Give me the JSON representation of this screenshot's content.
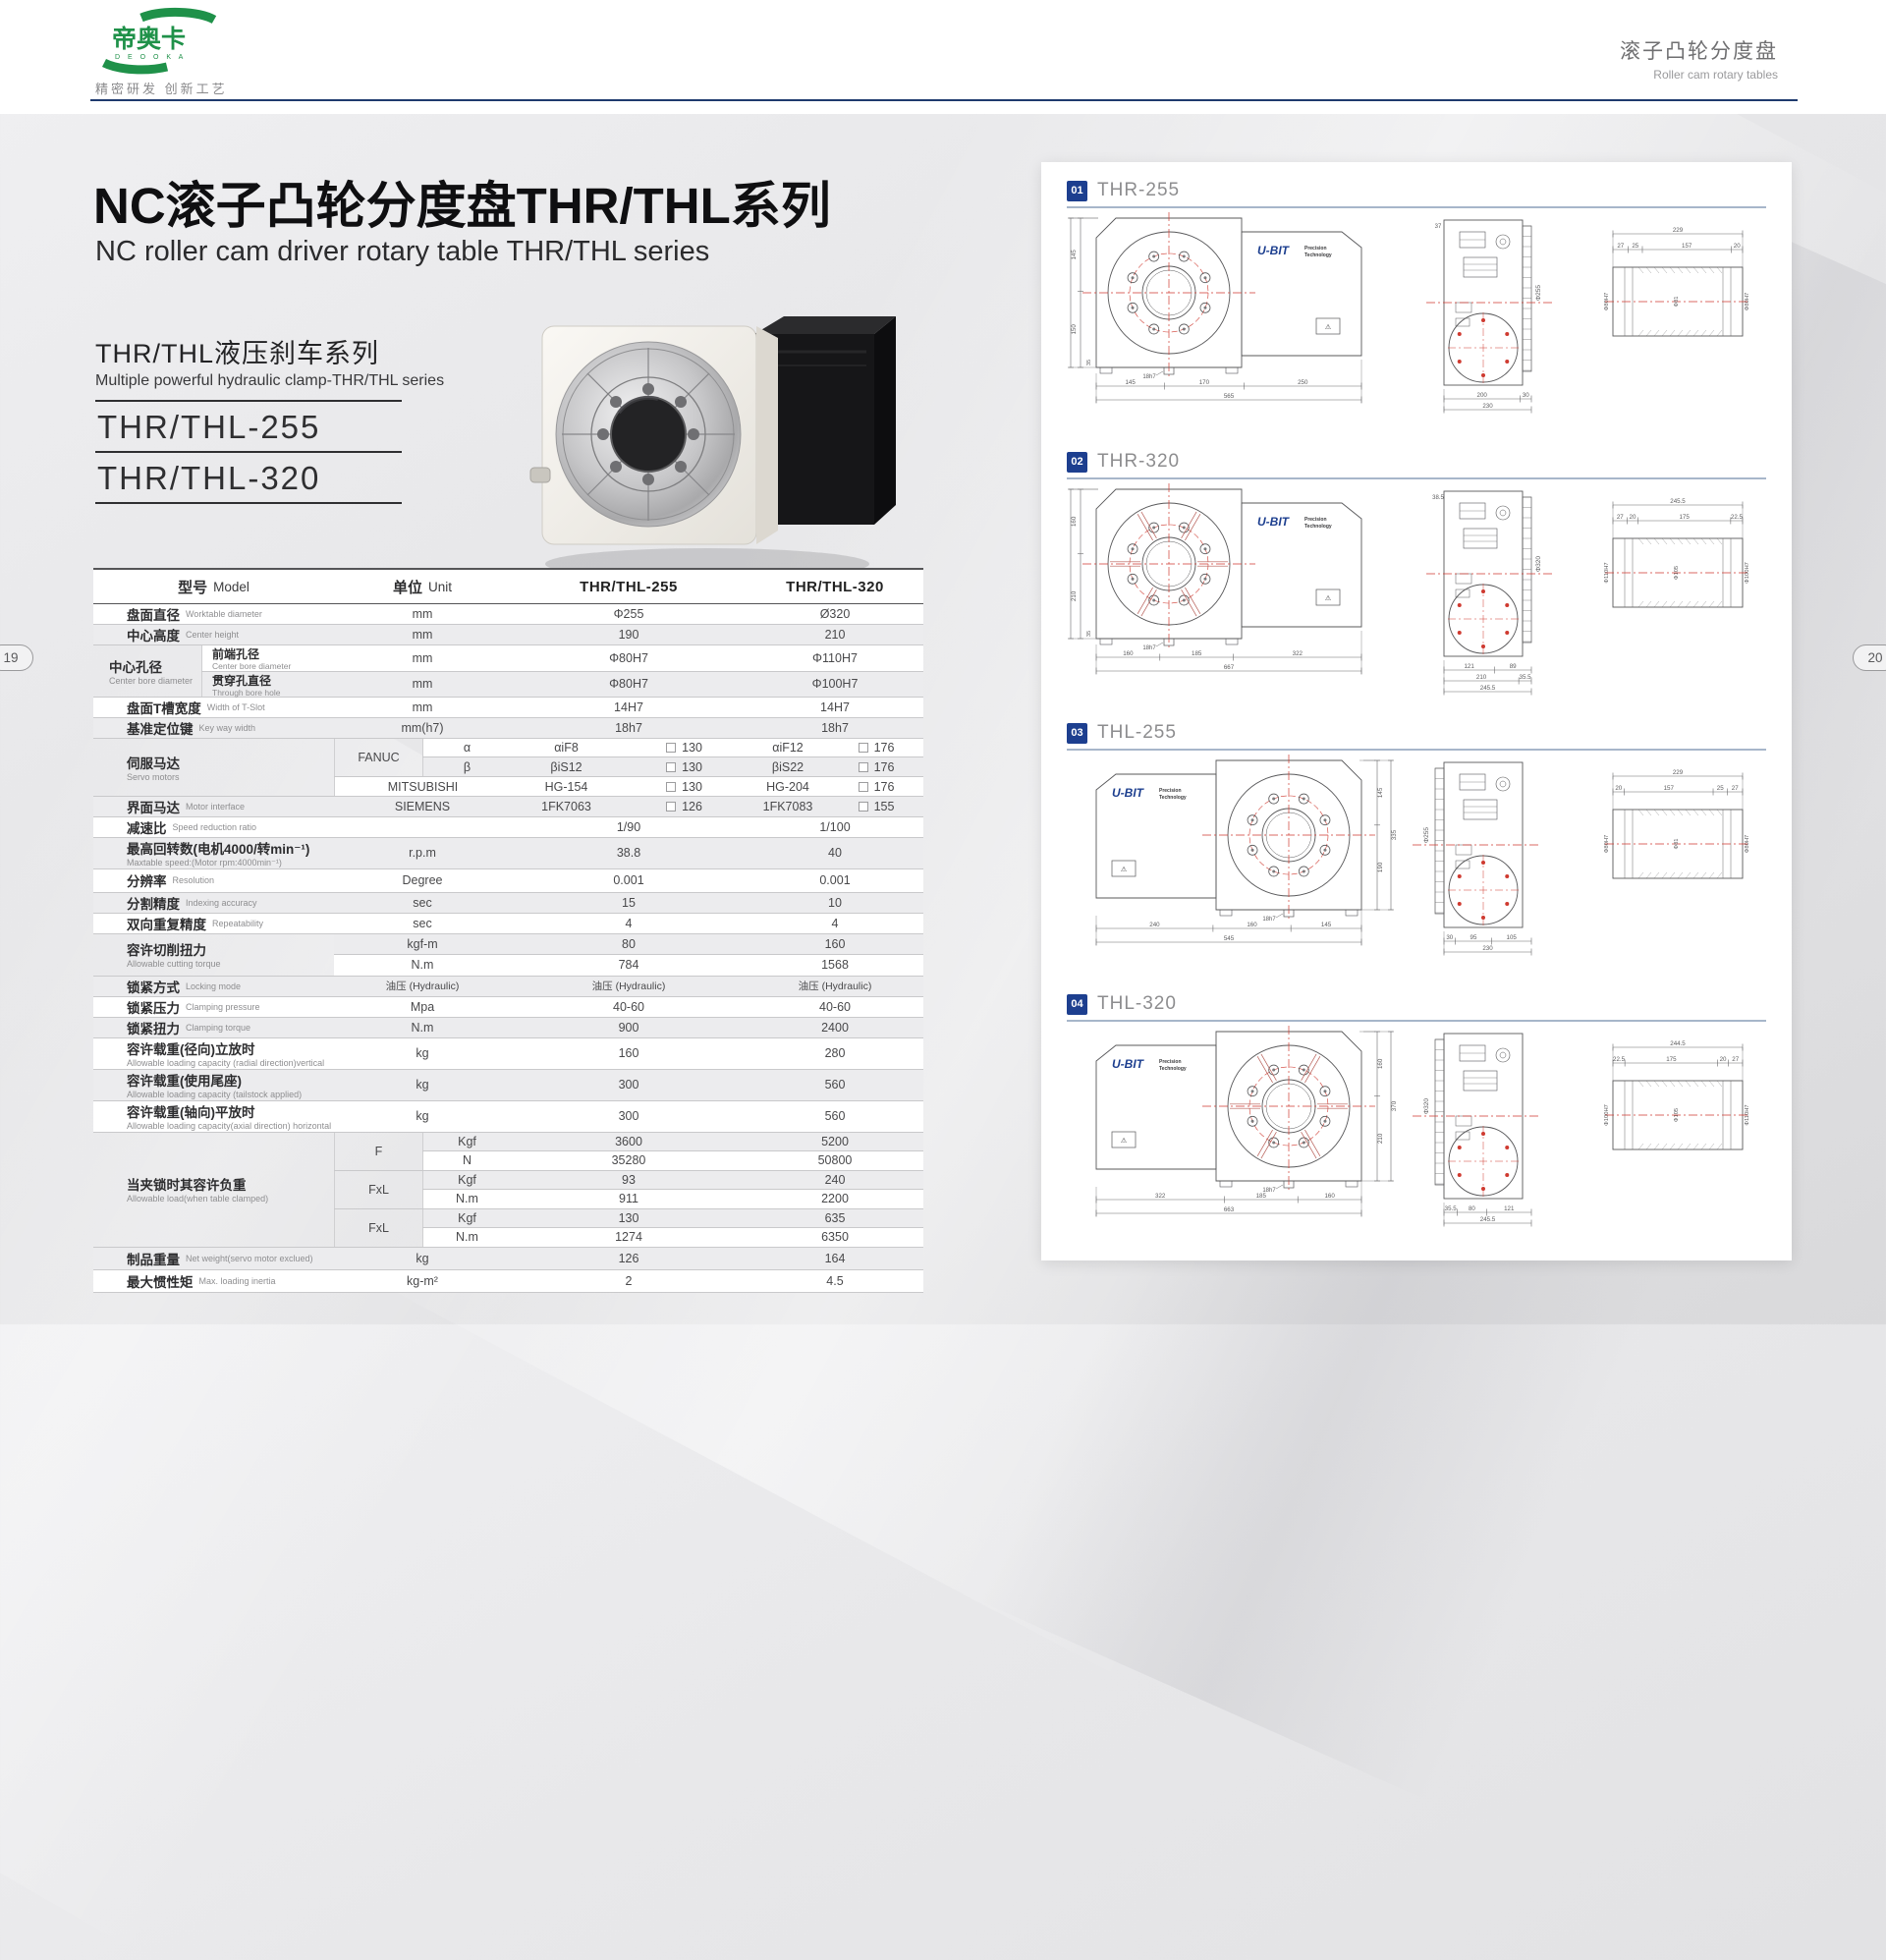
{
  "page": {
    "left_badge": "19",
    "right_badge": "20"
  },
  "header": {
    "logo_zh": "帝奥卡",
    "logo_latin": "D E O O K A",
    "tagline": "精密研发 创新工艺",
    "right_zh": "滚子凸轮分度盘",
    "right_en": "Roller cam rotary tables"
  },
  "intro": {
    "title_zh": "NC滚子凸轮分度盘THR/THL系列",
    "title_en": "NC roller cam driver rotary table THR/THL series",
    "series_zh": "THR/THL液压刹车系列",
    "series_en": "Multiple powerful hydraulic clamp-THR/THL series",
    "models": [
      "THR/THL-255",
      "THR/THL-320"
    ]
  },
  "spec_table": {
    "headers": {
      "model_zh": "型号",
      "model_en": "Model",
      "unit_zh": "单位",
      "unit_en": "Unit",
      "col_a": "THR/THL-255",
      "col_b": "THR/THL-320"
    },
    "rows": [
      {
        "type": "simple",
        "zh": "盘面直径",
        "en": "Worktable diameter",
        "unit": "mm",
        "a": "Φ255",
        "b": "Ø320"
      },
      {
        "type": "simple",
        "zh": "中心高度",
        "en": "Center height",
        "unit": "mm",
        "a": "190",
        "b": "210"
      },
      {
        "type": "bore",
        "zh": "中心孔径",
        "en": "Center bore diameter",
        "subs": [
          {
            "zh": "前端孔径",
            "en": "Center bore diameter",
            "unit": "mm",
            "a": "Φ80H7",
            "b": "Φ110H7"
          },
          {
            "zh": "贯穿孔直径",
            "en": "Through bore hole",
            "unit": "mm",
            "a": "Φ80H7",
            "b": "Φ100H7"
          }
        ]
      },
      {
        "type": "simple",
        "zh": "盘面T槽宽度",
        "en": "Width of T-Slot",
        "unit": "mm",
        "a": "14H7",
        "b": "14H7"
      },
      {
        "type": "simple",
        "zh": "基准定位键",
        "en": "Key way width",
        "unit": "mm(h7)",
        "a": "18h7",
        "b": "18h7"
      },
      {
        "type": "servo",
        "zh": "伺服马达",
        "en": "Servo motors",
        "fanuc": {
          "brand": "FANUC",
          "rows": [
            {
              "sub": "α",
              "a": "αiF8",
              "af": "130",
              "b": "αiF12",
              "bf": "176"
            },
            {
              "sub": "β",
              "a": "βiS12",
              "af": "130",
              "b": "βiS22",
              "bf": "176"
            }
          ]
        },
        "mits": {
          "brand": "MITSUBISHI",
          "a": "HG-154",
          "af": "130",
          "b": "HG-204",
          "bf": "176"
        }
      },
      {
        "type": "servo1",
        "zh": "界面马达",
        "en": "Motor interface",
        "brand": "SIEMENS",
        "a": "1FK7063",
        "af": "126",
        "b": "1FK7083",
        "bf": "155"
      },
      {
        "type": "simple",
        "zh": "减速比",
        "en": "Speed reduction ratio",
        "unit": "",
        "a": "1/90",
        "b": "1/100"
      },
      {
        "type": "simple",
        "zh": "最高回转数(电机4000/转min⁻¹)",
        "en": "Maxtable speed:(Motor rpm:4000min⁻¹)",
        "unit": "r.p.m",
        "a": "38.8",
        "b": "40",
        "h": 28,
        "stack": true
      },
      {
        "type": "simple",
        "zh": "分辨率",
        "en": "Resolution",
        "unit": "Degree",
        "a": "0.001",
        "b": "0.001",
        "h": 24
      },
      {
        "type": "simple",
        "zh": "分割精度",
        "en": "Indexing accuracy",
        "unit": "sec",
        "a": "15",
        "b": "10"
      },
      {
        "type": "simple",
        "zh": "双向重复精度",
        "en": "Repeatability",
        "unit": "sec",
        "a": "4",
        "b": "4"
      },
      {
        "type": "dual",
        "zh": "容许切削扭力",
        "en": "Allowable cutting torque",
        "subs": [
          {
            "unit": "kgf-m",
            "a": "80",
            "b": "160"
          },
          {
            "unit": "N.m",
            "a": "784",
            "b": "1568"
          }
        ]
      },
      {
        "type": "simple",
        "zh": "锁紧方式",
        "en": "Locking mode",
        "unit": "油压 (Hydraulic)",
        "a": "油压 (Hydraulic)",
        "b": "油压 (Hydraulic)",
        "smallv": true
      },
      {
        "type": "simple",
        "zh": "锁紧压力",
        "en": "Clamping pressure",
        "unit": "Mpa",
        "a": "40-60",
        "b": "40-60"
      },
      {
        "type": "simple",
        "zh": "锁紧扭力",
        "en": "Clamping torque",
        "unit": "N.m",
        "a": "900",
        "b": "2400"
      },
      {
        "type": "simple",
        "zh": "容许载重(径向)立放时",
        "en": "Allowable loading capacity (radial direction)vertical",
        "unit": "kg",
        "a": "160",
        "b": "280",
        "h": 28,
        "stack": true
      },
      {
        "type": "simple",
        "zh": "容许载重(使用尾座)",
        "en": "Allowable loading capacity (tailstock applied)",
        "unit": "kg",
        "a": "300",
        "b": "560",
        "h": 28,
        "stack": true
      },
      {
        "type": "simple",
        "zh": "容许载重(轴向)平放时",
        "en": "Allowable loading capacity(axial direction) horizontal",
        "unit": "kg",
        "a": "300",
        "b": "560",
        "h": 32,
        "stack": true
      },
      {
        "type": "clamp",
        "zh": "当夹锁时其容许负重",
        "en": "Allowable load(when table clamped)",
        "pairs": [
          {
            "f": "F",
            "rows": [
              [
                "Kgf",
                "3600",
                "5200"
              ],
              [
                "N",
                "35280",
                "50800"
              ]
            ]
          },
          {
            "f": "FxL",
            "rows": [
              [
                "Kgf",
                "93",
                "240"
              ],
              [
                "N.m",
                "911",
                "2200"
              ]
            ]
          },
          {
            "f": "FxL",
            "rows": [
              [
                "Kgf",
                "130",
                "635"
              ],
              [
                "N.m",
                "1274",
                "6350"
              ]
            ]
          }
        ]
      },
      {
        "type": "simple",
        "zh": "制品重量",
        "en": "Net weight(servo motor exclued)",
        "unit": "kg",
        "a": "126",
        "b": "164",
        "h": 23
      },
      {
        "type": "simple",
        "zh": "最大惯性矩",
        "en": "Max. loading inertia",
        "unit": "kg-m²",
        "a": "2",
        "b": "4.5",
        "h": 23
      }
    ]
  },
  "drawings": {
    "brand": "U-BIT",
    "brand_sub1": "Precision",
    "brand_sub2": "Technology",
    "sections": [
      {
        "badge": "01",
        "title": "THR-255",
        "mirror": false,
        "spokes": false,
        "front": {
          "vdims": [
            "145",
            "335",
            "150"
          ],
          "bottom": [
            [
              "145",
              "170",
              "250"
            ],
            [
              "565"
            ]
          ],
          "key": "18h7",
          "foot": "35"
        },
        "side": {
          "top": "37",
          "dia": "Φ255",
          "bottom": [
            [
              "200",
              "30"
            ],
            [
              "230"
            ]
          ]
        },
        "end": {
          "top": [
            [
              "229"
            ],
            [
              "27",
              "25",
              "157",
              "20"
            ]
          ],
          "bores": [
            "Φ80H7",
            "Φ81",
            "Φ80H7"
          ]
        }
      },
      {
        "badge": "02",
        "title": "THR-320",
        "mirror": false,
        "spokes": true,
        "front": {
          "vdims": [
            "160",
            "370",
            "210"
          ],
          "bottom": [
            [
              "160",
              "185",
              "322"
            ],
            [
              "667"
            ]
          ],
          "key": "18h7",
          "foot": "35"
        },
        "side": {
          "top": "38.5",
          "dia": "Φ320",
          "bottom": [
            [
              "121",
              "89"
            ],
            [
              "210",
              "35.5"
            ],
            [
              "245.5"
            ]
          ]
        },
        "end": {
          "top": [
            [
              "245.5"
            ],
            [
              "27",
              "20",
              "175",
              "22.5"
            ]
          ],
          "bores": [
            "Φ110H7",
            "Φ105",
            "Φ100H7"
          ]
        }
      },
      {
        "badge": "03",
        "title": "THL-255",
        "mirror": true,
        "spokes": false,
        "front": {
          "vdims": [
            "145",
            "335",
            "190"
          ],
          "bottom": [
            [
              "240",
              "160",
              "145"
            ],
            [
              "545"
            ]
          ],
          "key": "18h7",
          "foot": ""
        },
        "side": {
          "top": "",
          "dia": "Φ255",
          "bottom": [
            [
              "30",
              "95",
              "105"
            ],
            [
              "230"
            ]
          ]
        },
        "end": {
          "top": [
            [
              "229"
            ],
            [
              "20",
              "157",
              "25",
              "27"
            ]
          ],
          "bores": [
            "Φ80H7",
            "Φ81",
            "Φ80H7"
          ]
        }
      },
      {
        "badge": "04",
        "title": "THL-320",
        "mirror": true,
        "spokes": true,
        "front": {
          "vdims": [
            "160",
            "370",
            "210"
          ],
          "bottom": [
            [
              "322",
              "185",
              "160"
            ],
            [
              "663"
            ]
          ],
          "key": "18h7",
          "foot": ""
        },
        "side": {
          "top": "",
          "dia": "Φ320",
          "bottom": [
            [
              "35.5",
              "80",
              "121"
            ],
            [
              "245.5"
            ]
          ]
        },
        "end": {
          "top": [
            [
              "244.5"
            ],
            [
              "22.5",
              "175",
              "20",
              "27"
            ]
          ],
          "bores": [
            "Φ100H7",
            "Φ105",
            "Φ110H7"
          ]
        }
      }
    ]
  },
  "colors": {
    "navy": "#1d3f8f",
    "red": "#cf3a30",
    "green": "#1f9149",
    "rule_navy": "#1e3a6e"
  }
}
